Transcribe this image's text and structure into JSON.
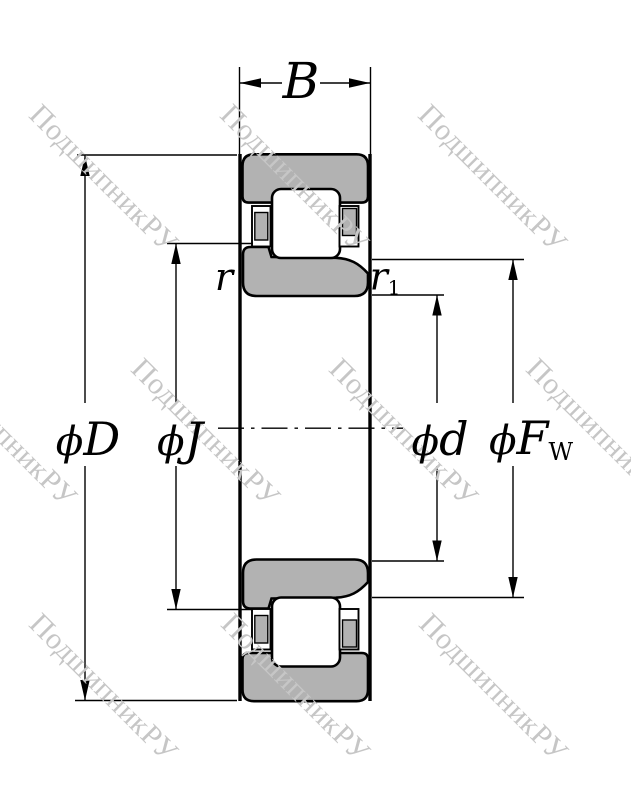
{
  "watermark": {
    "text": "ПодшипникРУ"
  },
  "dims": {
    "B": {
      "label": "B"
    },
    "D": {
      "symbol": "ϕ",
      "label": "D"
    },
    "J": {
      "symbol": "ϕ",
      "label": "J"
    },
    "d": {
      "symbol": "ϕ",
      "label": "d"
    },
    "FW": {
      "symbol": "ϕ",
      "label": "F",
      "subscript": "W"
    },
    "r": {
      "label": "r"
    },
    "r1": {
      "label": "r",
      "subscript": "1"
    }
  },
  "colors": {
    "ring_fill": "#b2b2b2",
    "line": "#000000",
    "background": "#ffffff",
    "watermark": "#c6c6c6"
  }
}
